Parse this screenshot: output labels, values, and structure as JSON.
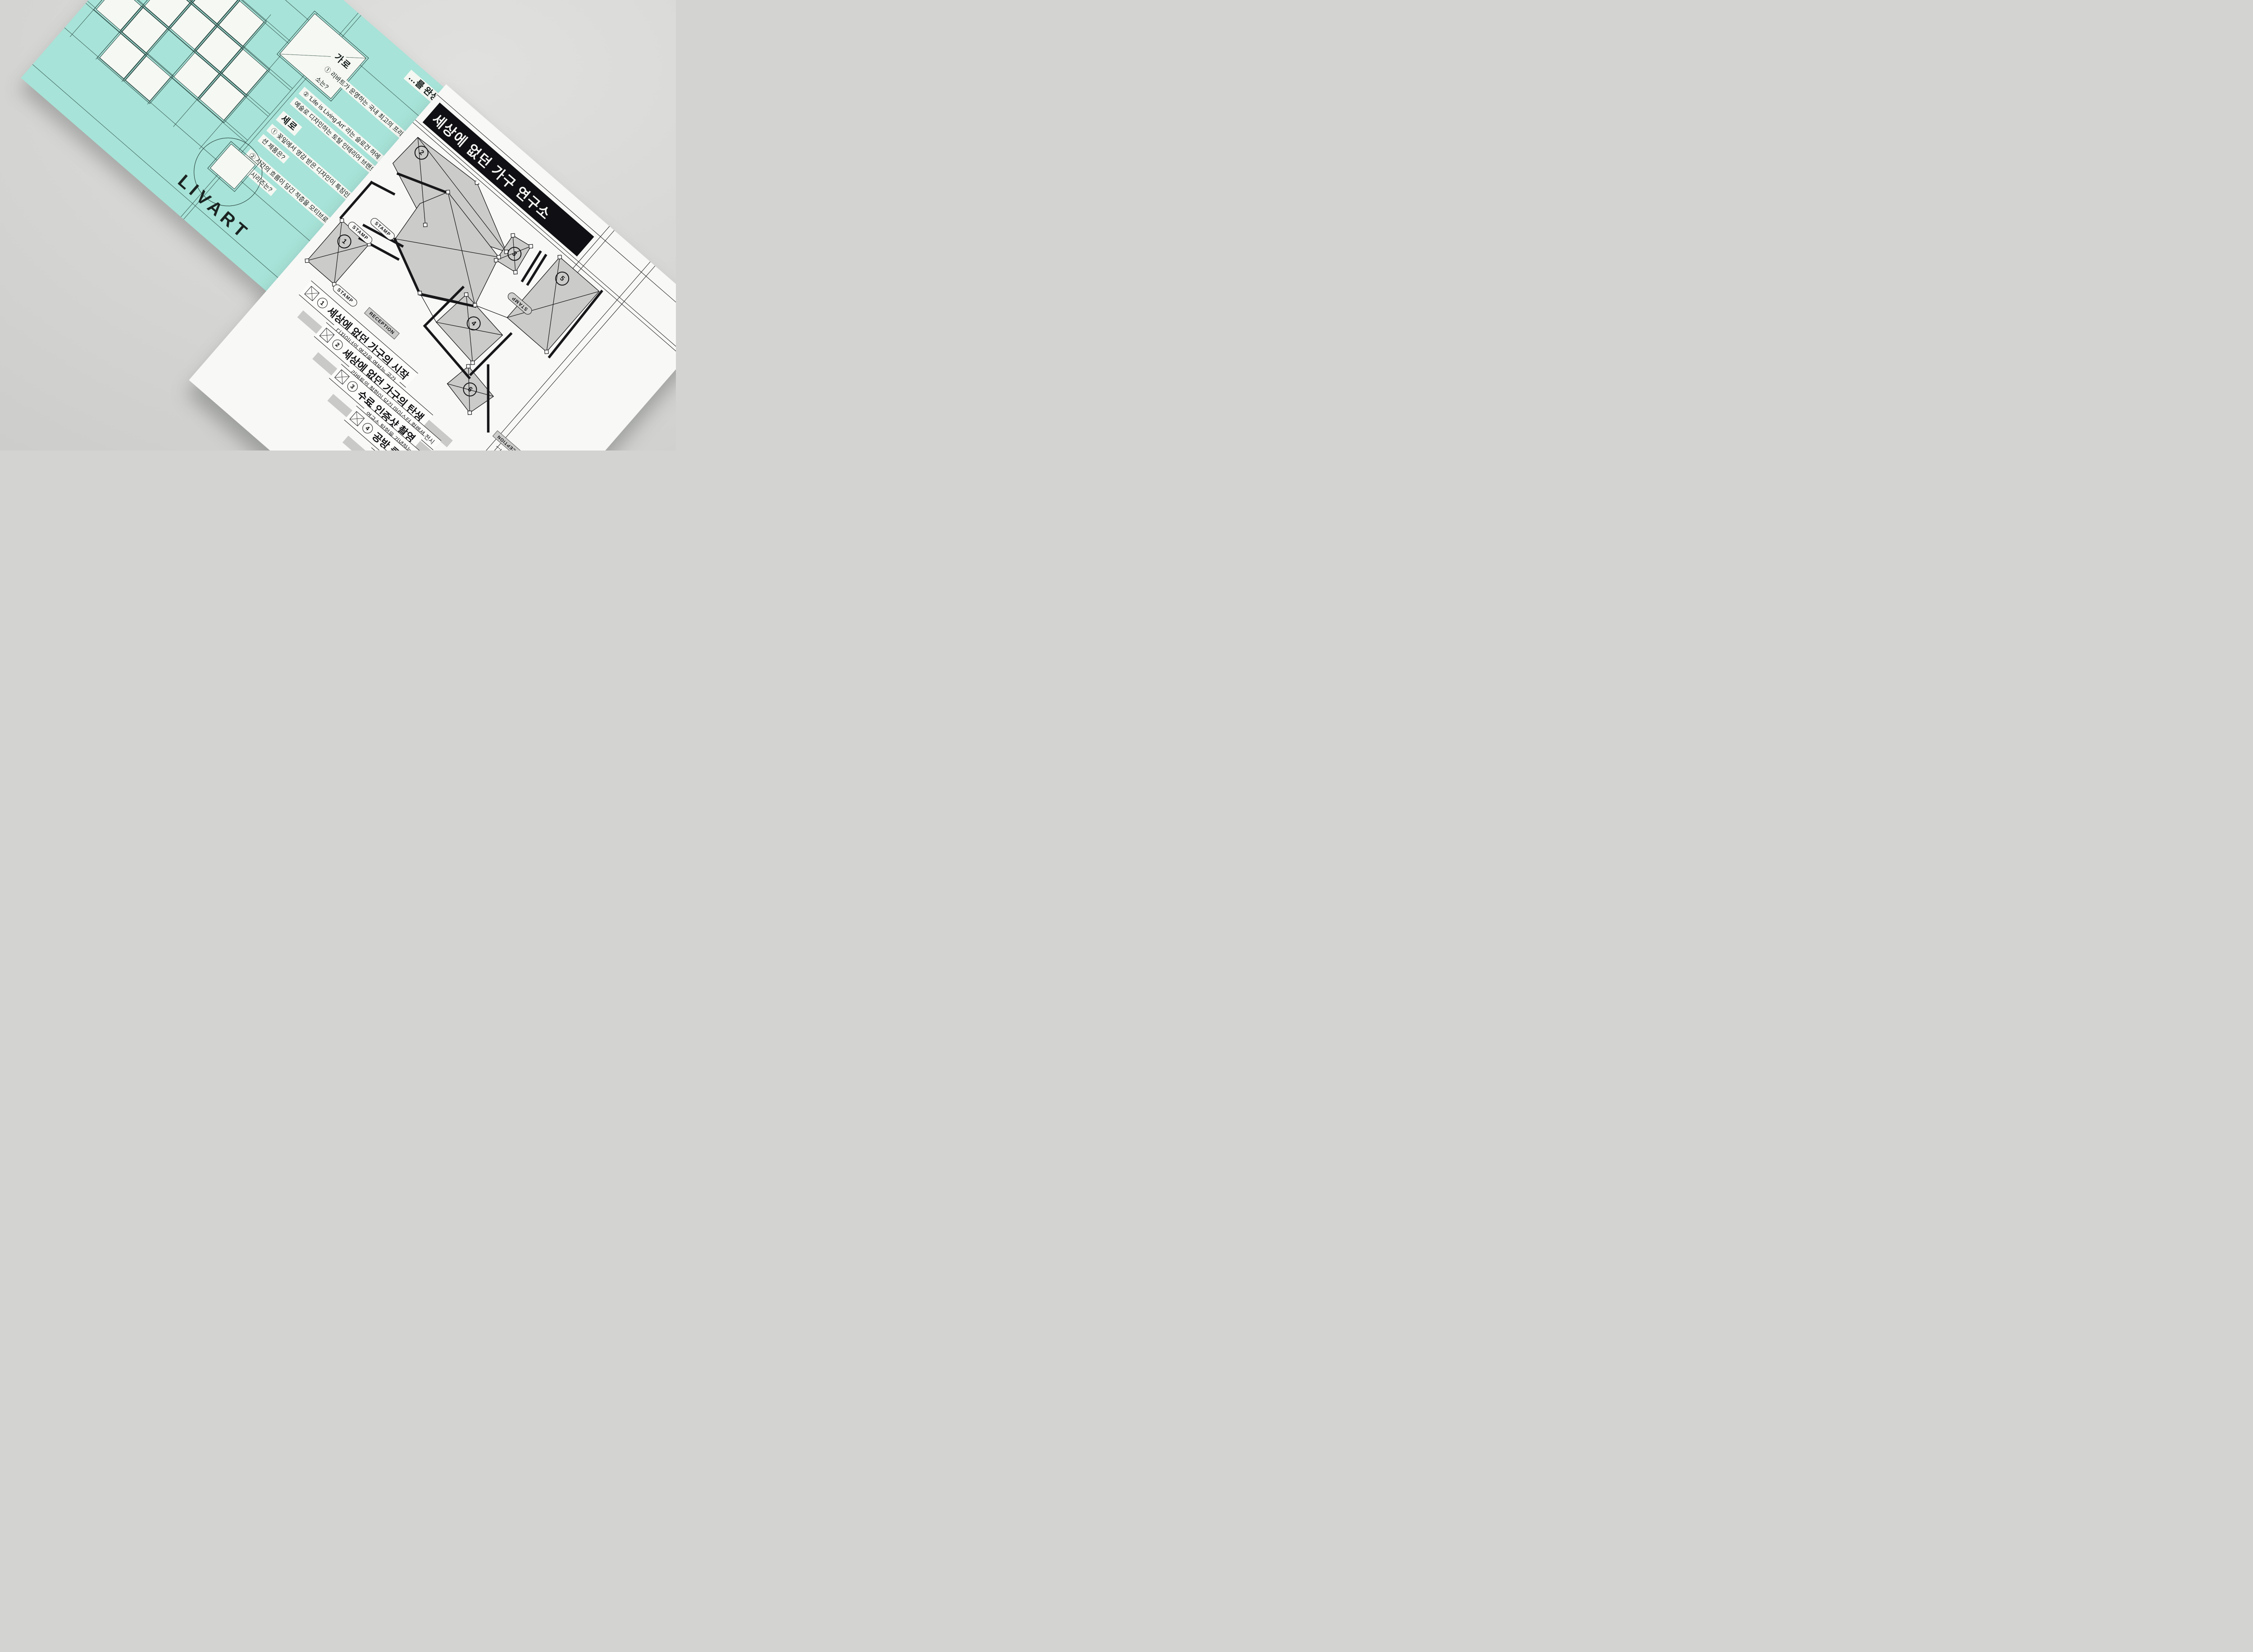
{
  "scene": {
    "colors": {
      "background": "#d5d5d3",
      "teal_card": "#a7e3d8",
      "card_ink": "#17171a",
      "plan_gray": "#cbcbc9",
      "white_card": "#f8f8f6"
    }
  },
  "teal_card": {
    "brand": "LIVART",
    "title_fragment": "…를 완성해보세요",
    "grid_letter": "리",
    "across": {
      "label": "가로",
      "clues": [
        "① 리바트가 운영하는 국내 최고의 프리미엄 가구 연구소는?",
        "② 'Life is Living Art' 라는 슬로건 하에 고객의 생활을 예술로 디자인하는 토탈 인테리어 브랜드는?"
      ]
    },
    "down": {
      "label": "세로",
      "clues": [
        "① 꽃잎에서 영감 받은 디자인이 특징인 마이스터 컬렉션 제품은?",
        "② 시간의 흐름이 담긴 적층을 모티브로 한 마이스터 컬렉션 시리즈는?"
      ]
    }
  },
  "white_card": {
    "title": "세상에 없던 가구 연구소",
    "plan": {
      "stamp_label": "STAMP",
      "reception_label": "RECEPTION",
      "markers": [
        "1",
        "2",
        "3",
        "4",
        "5",
        "6"
      ]
    },
    "legend": [
      {
        "num": "1",
        "heading": "세상에 없던 가구의 시작",
        "subtitle": "디자이너의 영감을 엿보는 공간"
      },
      {
        "num": "2",
        "heading": "세상에 없던 가구의 탄생",
        "subtitle": "리바트의 철학이 담긴 마이스터 컬렉션 전시"
      },
      {
        "num": "3",
        "heading": "수료 인증샷 촬영",
        "subtitle": "연구소 탐험을 기념하는 사진 한 컷"
      },
      {
        "num": "4",
        "heading": "공방 클래스 체험",
        "subtitle": "수공예로 완성 되는…"
      },
      {
        "num": "5",
        "heading": "리바트 굿…",
        "subtitle": "리바트…"
      }
    ],
    "footer": {
      "note1": "스탬프를 찍어…",
      "stamp_label": "STAMP",
      "note2": "리셉션에서…",
      "reception_label": "RECEPTION"
    }
  }
}
